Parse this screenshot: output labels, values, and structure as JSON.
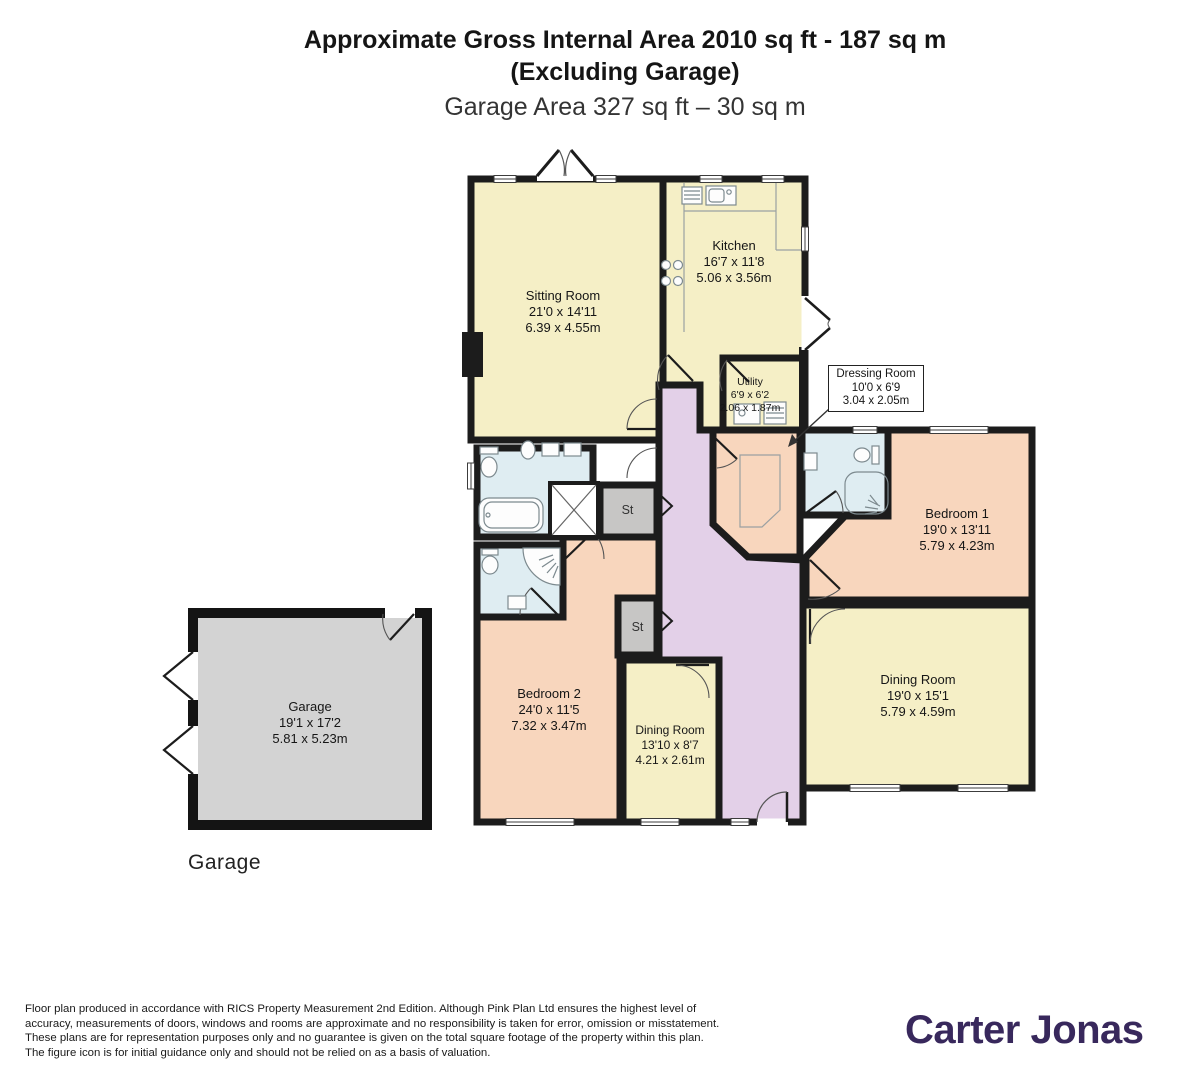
{
  "title": {
    "line1": "Approximate Gross Internal Area 2010 sq ft - 187 sq m",
    "line2": "(Excluding Garage)",
    "line3": "Garage Area 327 sq ft – 30 sq m"
  },
  "rooms": [
    {
      "name": "Sitting Room",
      "imperial": "21'0 x 14'11",
      "metric": "6.39 x 4.55m"
    },
    {
      "name": "Kitchen",
      "imperial": "16'7 x 11'8",
      "metric": "5.06 x 3.56m"
    },
    {
      "name": "Utility",
      "imperial": "6'9 x 6'2",
      "metric": "2.06 x 1.87m"
    },
    {
      "name": "Dressing Room",
      "imperial": "10'0 x 6'9",
      "metric": "3.04 x 2.05m"
    },
    {
      "name": "Bedroom 1",
      "imperial": "19'0 x 13'11",
      "metric": "5.79 x 4.23m"
    },
    {
      "name": "Dining Room",
      "imperial": "19'0 x 15'1",
      "metric": "5.79 x 4.59m"
    },
    {
      "name": "Bedroom 2",
      "imperial": "24'0 x 11'5",
      "metric": "7.32 x 3.47m"
    },
    {
      "name": "Dining Room",
      "imperial": "13'10 x 8'7",
      "metric": "4.21 x 2.61m"
    },
    {
      "name": "Garage",
      "imperial": "19'1 x 17'2",
      "metric": "5.81 x 5.23m"
    }
  ],
  "labels": {
    "storage": "St"
  },
  "captions": {
    "garage": "Garage"
  },
  "footer": {
    "disclaimer": "Floor plan produced in accordance with RICS Property Measurement 2nd Edition. Although Pink Plan Ltd ensures the highest level of accuracy, measurements of doors, windows and rooms are approximate and no responsibility is taken for error, omission or misstatement. These plans are for representation purposes only and no guarantee is given on the total square footage of the property within this plan. The figure icon is for initial guidance only and should not be relied on as a basis of valuation.",
    "brand": "Carter Jonas"
  },
  "colors": {
    "cream": "#f5efc6",
    "peach": "#f8d6bd",
    "blue": "#dfedf2",
    "lilac": "#e3d0e8",
    "storage_gray": "#c7c6c5",
    "garage_gray": "#d3d3d3",
    "wall": "#1c1c1c",
    "brand_purple": "#38285c"
  }
}
